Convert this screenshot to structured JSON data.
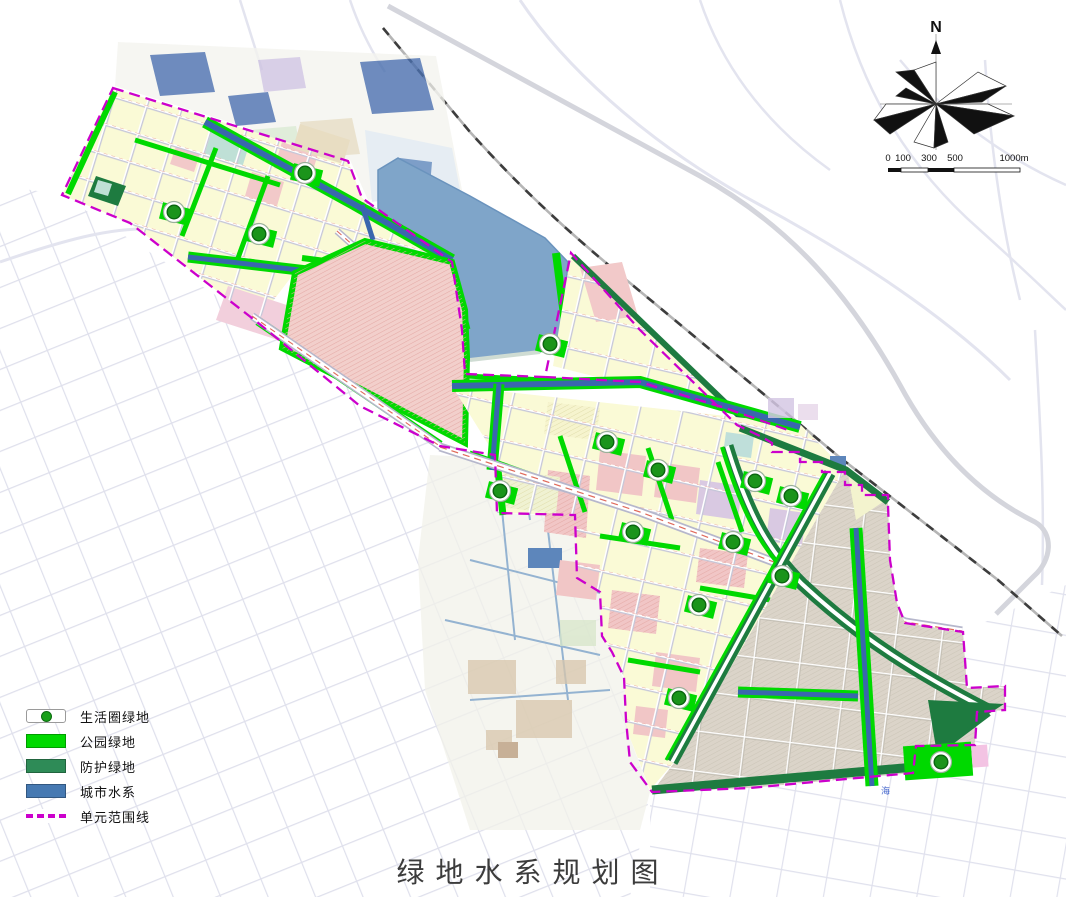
{
  "title": "绿地水系规划图",
  "legend": {
    "items": [
      {
        "label": "生活圈绿地",
        "type": "marker",
        "color": "#18A018"
      },
      {
        "label": "公园绿地",
        "type": "fill",
        "color": "#00D900"
      },
      {
        "label": "防护绿地",
        "type": "fill",
        "color": "#2E8B57"
      },
      {
        "label": "城市水系",
        "type": "fill",
        "color": "#4679B2"
      },
      {
        "label": "单元范围线",
        "type": "dashed-line",
        "color": "#CC00CC"
      }
    ]
  },
  "compass": {
    "north_label": "N"
  },
  "scale_bar": {
    "labels": [
      "0",
      "100",
      "300",
      "500",
      "1000m"
    ]
  },
  "map": {
    "river_labels": [
      {
        "text": "海",
        "x": 881,
        "y": 794
      }
    ],
    "life_circle_markers": [
      {
        "x": 305,
        "y": 173
      },
      {
        "x": 174,
        "y": 212
      },
      {
        "x": 259,
        "y": 234
      },
      {
        "x": 550,
        "y": 344
      },
      {
        "x": 607,
        "y": 442
      },
      {
        "x": 658,
        "y": 470
      },
      {
        "x": 500,
        "y": 491
      },
      {
        "x": 755,
        "y": 481
      },
      {
        "x": 791,
        "y": 496
      },
      {
        "x": 633,
        "y": 532
      },
      {
        "x": 733,
        "y": 542
      },
      {
        "x": 782,
        "y": 576
      },
      {
        "x": 699,
        "y": 605
      },
      {
        "x": 679,
        "y": 698
      },
      {
        "x": 941,
        "y": 762
      }
    ],
    "colors": {
      "park_green": "#00D900",
      "protective_green": "#1E7B40",
      "water_canal": "#3A67AD",
      "lake": "#7FA5C9",
      "boundary_magenta": "#CC00CC",
      "residential_yellow": "#FAFAD6",
      "pink_zone": "#F2CFCB",
      "se_tan": "#DBD4C9"
    }
  }
}
